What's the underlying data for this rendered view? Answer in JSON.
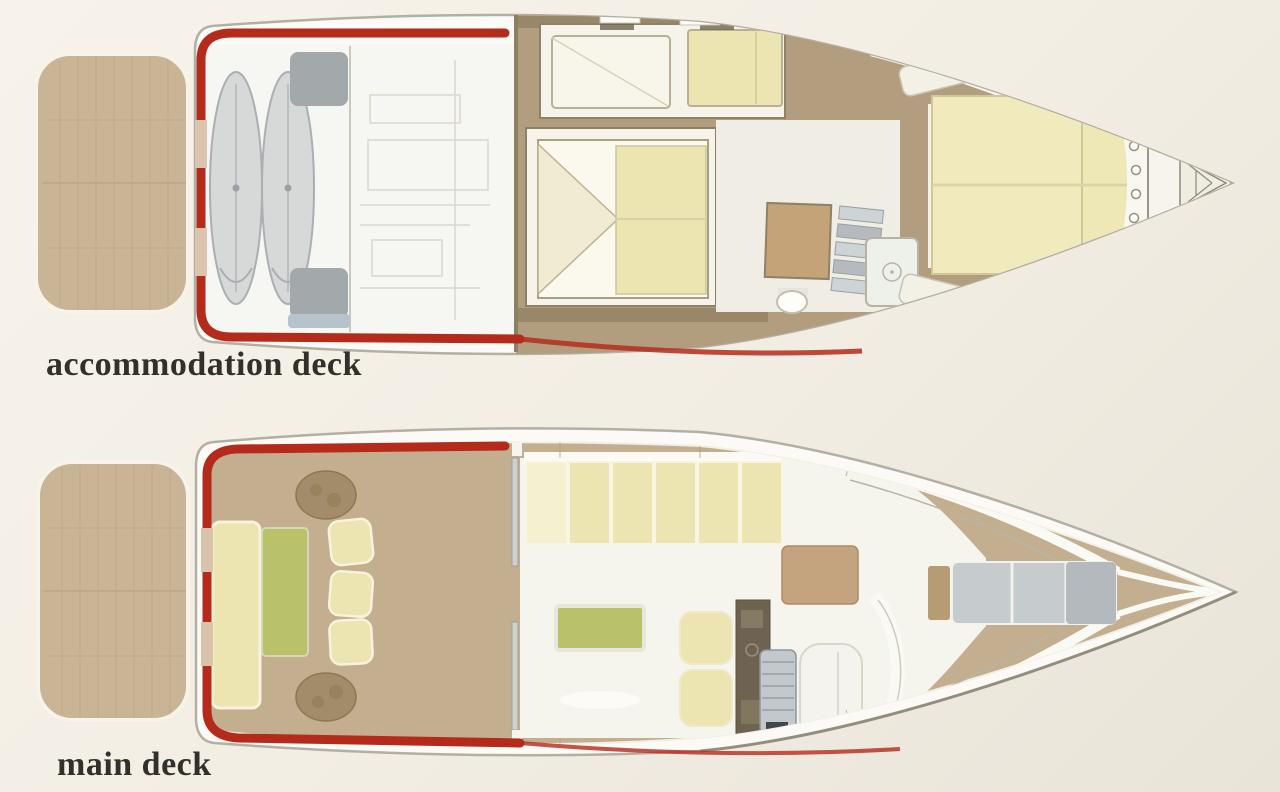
{
  "page": {
    "background": "#f3eee4"
  },
  "decks": {
    "accommodation": {
      "label": "accommodation deck"
    },
    "main": {
      "label": "main deck"
    }
  },
  "palette": {
    "hull_white": "#fbfaf6",
    "hull_outline": "#b3afa3",
    "platform_tan": "#c9b495",
    "deck_tan": "#c3ae8f",
    "cabin_floor": "#b29e7e",
    "cabin_wall": "#8d7f61",
    "cushion_yellow": "#ece5b2",
    "cushion_yellow_light": "#f4f0d0",
    "accent_green": "#b9c16b",
    "accent_red": "#b42b1c",
    "engine_gray": "#d7d9d8",
    "machinery_gray": "#a3a9ab",
    "sunpad_gray": "#c6cbcd",
    "label_color": "#32302b"
  }
}
